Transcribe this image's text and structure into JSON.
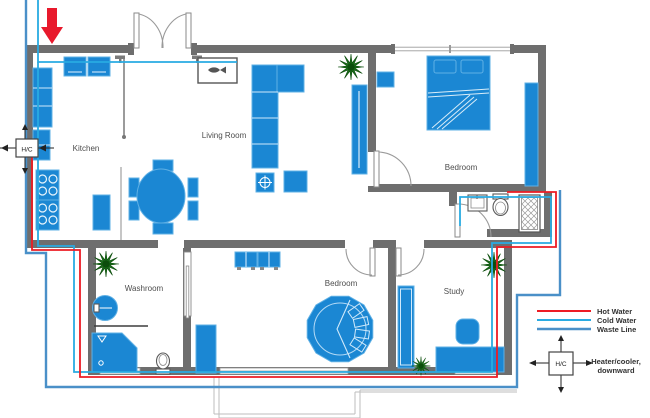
{
  "rooms": {
    "kitchen": "Kitchen",
    "living_room": "Living Room",
    "bedroom_top": "Bedroom",
    "bedroom_bottom": "Bedroom",
    "washroom": "Washroom",
    "study": "Study"
  },
  "units": {
    "hc_wall": "H/C",
    "hc_legend": "H/C"
  },
  "legend": {
    "items": [
      {
        "name": "hot-water",
        "label": "Hot Water",
        "color": "#ED1C24"
      },
      {
        "name": "cold-water",
        "label": "Cold Water",
        "color": "#29ABE2"
      },
      {
        "name": "waste-line",
        "label": "Waste Line",
        "color": "#4A90C8"
      }
    ],
    "heater_note_line1": "Heater/cooler,",
    "heater_note_line2": "downward"
  },
  "colors": {
    "wall": "#6E6E6E",
    "furniture": "#1B87D3",
    "furniture_edge": "#5FB0E5",
    "plant": "#1A6E1A",
    "hot": "#ED1C24",
    "cold": "#29ABE2",
    "waste": "#4A90C8",
    "supply_arrow": "#E8192C"
  },
  "icons": {
    "plant": "plant-icon",
    "heater_unit": "hc-unit",
    "supply_arrow": "down-arrow-icon"
  }
}
